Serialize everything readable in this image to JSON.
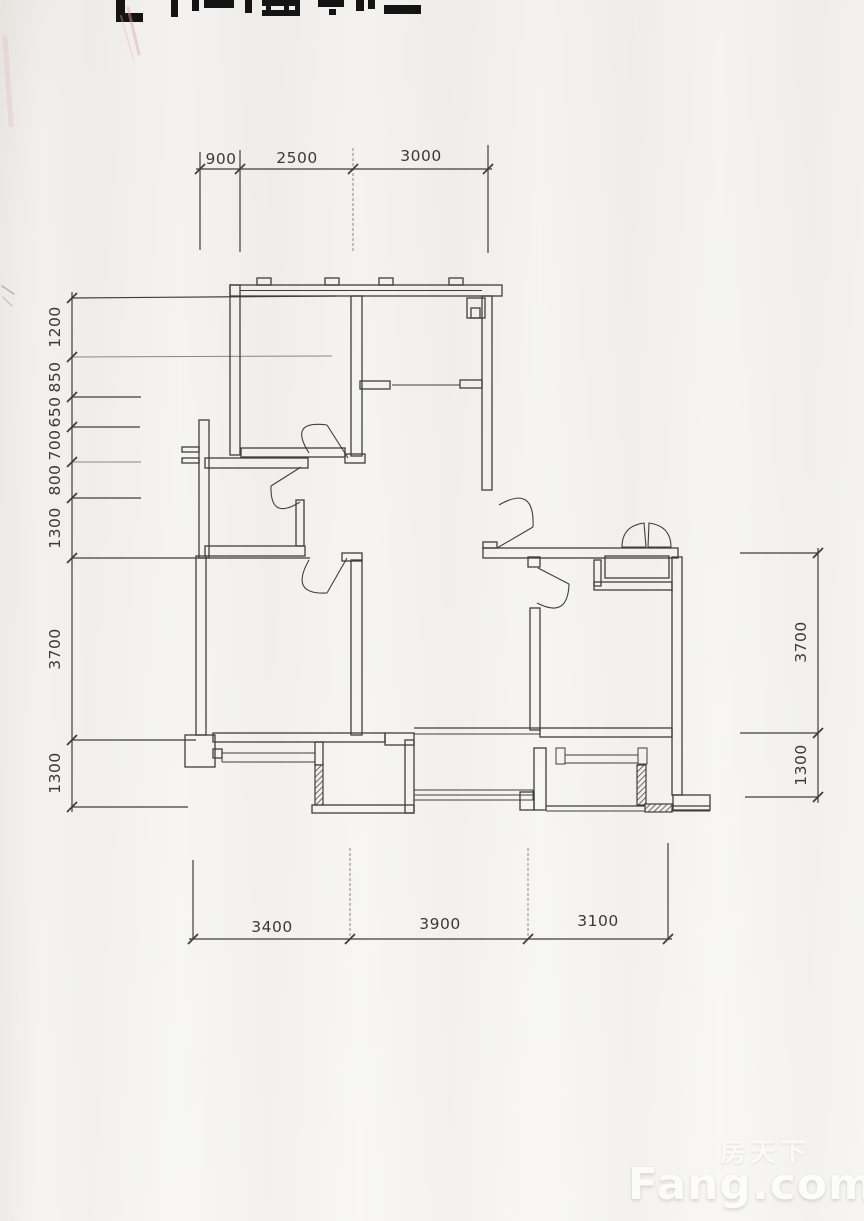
{
  "dimensions": {
    "top": [
      "900",
      "2500",
      "3000"
    ],
    "left": [
      "1200",
      "850",
      "650",
      "700",
      "800",
      "1300",
      "3700",
      "1300"
    ],
    "right": [
      "3700",
      "1300"
    ],
    "bottom": [
      "3400",
      "3900",
      "3100"
    ]
  },
  "watermark": {
    "cjk": "房天下",
    "latin": "Fang.com"
  },
  "colors": {
    "paper": "#f1f0ed",
    "ink": "#3f3e3c",
    "faint_line": "#8a8884",
    "watermark": "#fcfcfa",
    "smudge_pink": "#dfa3ad"
  }
}
